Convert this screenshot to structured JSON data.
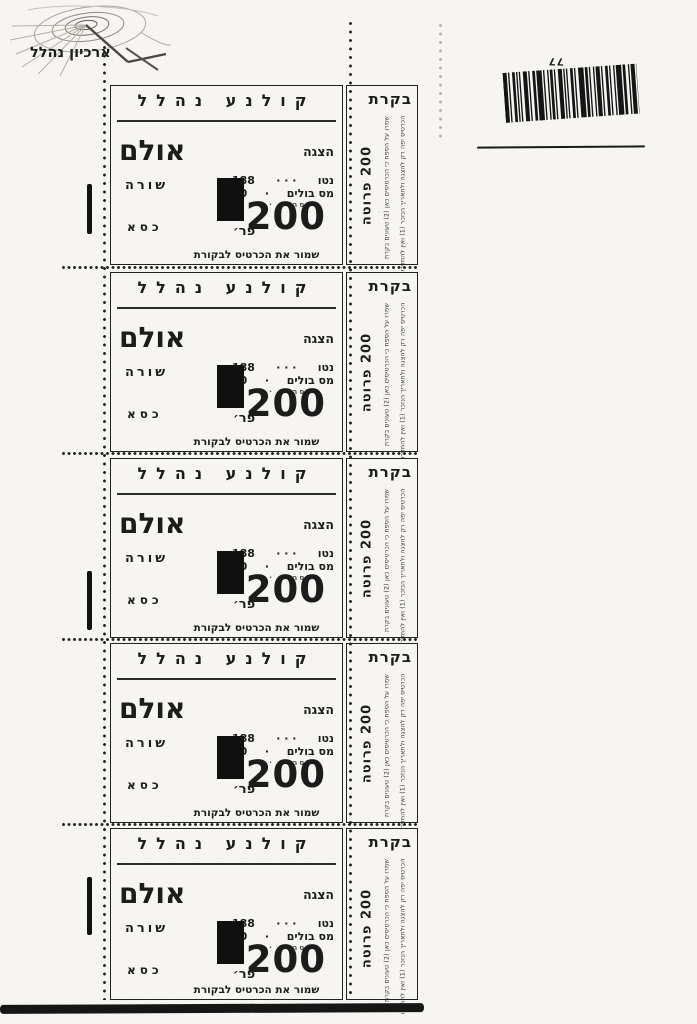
{
  "paper_color": "#f6f5f1",
  "ink_color": "#1c1c1c",
  "archive": {
    "name": "ארכיון נהלל"
  },
  "barcode": {
    "handwritten_number": "77"
  },
  "sheet": {
    "tickets_count": 5
  },
  "ticket": {
    "cinema_name": "קולנע נהלל",
    "show_label": "הצגה",
    "hall_label": "אולם",
    "row_label": "שורה",
    "seat_label": "כסא",
    "net_label": "נטו",
    "net_leader": "· · ·",
    "net_value": "188",
    "tax_label": "מס בולים",
    "tax_leader": "·",
    "tax_value": "10",
    "total_label": "סה״כ · ·",
    "price_unit": "פר׳",
    "price_value": "200",
    "keep_note": "שמור את הכרטיס לבקורת",
    "stub": {
      "title": "בקרת",
      "condition_line_1": "הכרטיס יפה רק להצגה ולתאריך הנזכר (1) ואין להחזירו",
      "condition_line_2": "שמרו על הספח כי הכרטיסים כאן (2) טעונים בקרת",
      "price": "200 פרוטה"
    }
  }
}
